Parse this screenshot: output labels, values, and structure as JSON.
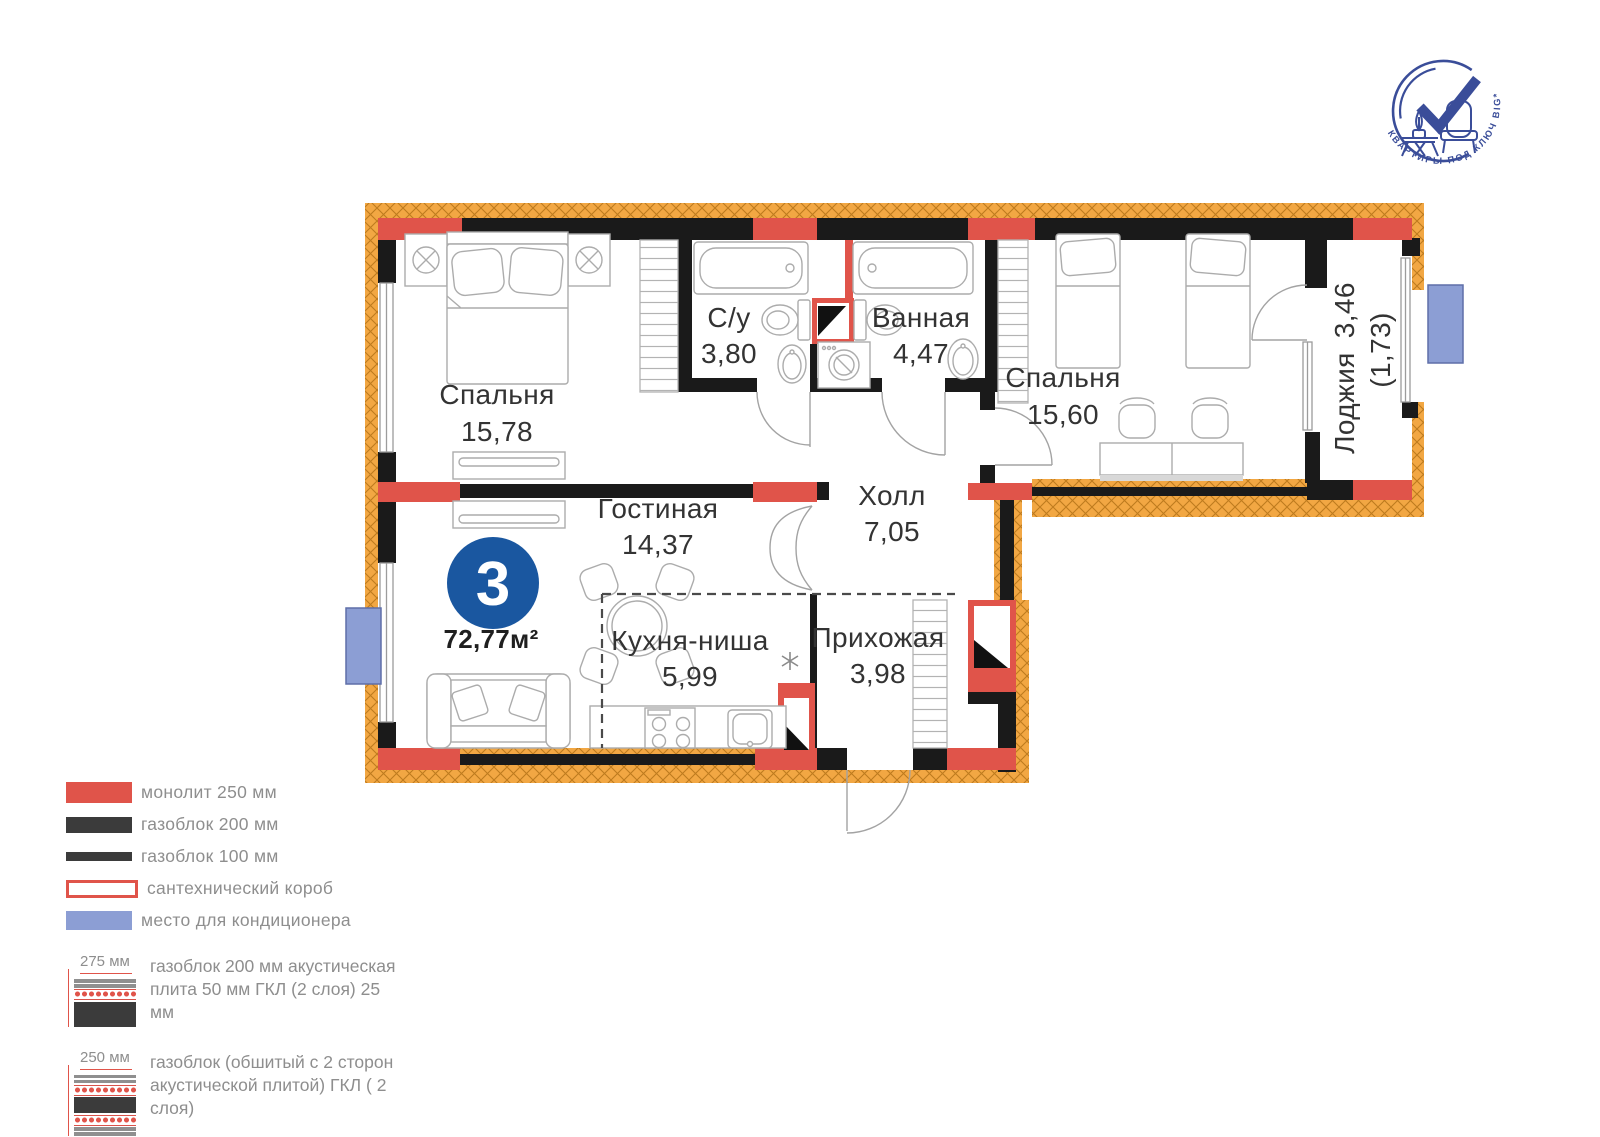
{
  "logo": {
    "arc_text": "КВАРТИРЫ ПОД КЛЮЧ BIG*"
  },
  "plan": {
    "badge": {
      "number": "3",
      "total_area": "72,77м²"
    },
    "rooms": [
      {
        "name": "Спальня",
        "area": "15,78"
      },
      {
        "name": "С/у",
        "area": "3,80"
      },
      {
        "name": "Ванная",
        "area": "4,47"
      },
      {
        "name": "Спальня",
        "area": "15,60"
      },
      {
        "name": "Лоджия",
        "area": "3,46",
        "area_reduced": "(1,73)"
      },
      {
        "name": "Гостиная",
        "area": "14,37"
      },
      {
        "name": "Холл",
        "area": "7,05"
      },
      {
        "name": "Кухня-ниша",
        "area": "5,99"
      },
      {
        "name": "Прихожая",
        "area": "3,98"
      }
    ]
  },
  "legend": {
    "items": [
      {
        "type": "monolith",
        "label": "монолит 250 мм"
      },
      {
        "type": "gasblock-200",
        "label": "газоблок 200 мм"
      },
      {
        "type": "gasblock-100",
        "label": "газоблок 100 мм"
      },
      {
        "type": "plumbing-box",
        "label": "сантехнический короб"
      },
      {
        "type": "ac-place",
        "label": "место для кондиционера"
      }
    ],
    "assemblies": [
      {
        "dim": "275 мм",
        "label": "газоблок 200 мм акустическая плита 50 мм ГКЛ (2 слоя) 25 мм"
      },
      {
        "dim": "250 мм",
        "label": "газоблок (обшитый с 2 сторон акустической плитой) ГКЛ ( 2 слоя)"
      }
    ]
  },
  "colors": {
    "monolith": "#E0544A",
    "gasblock": "#3B3B3B",
    "insulation": "#F2A743",
    "ac_place": "#8C9ED4",
    "badge_circle": "#1A57A0",
    "logo_blue": "#3A4D99"
  }
}
